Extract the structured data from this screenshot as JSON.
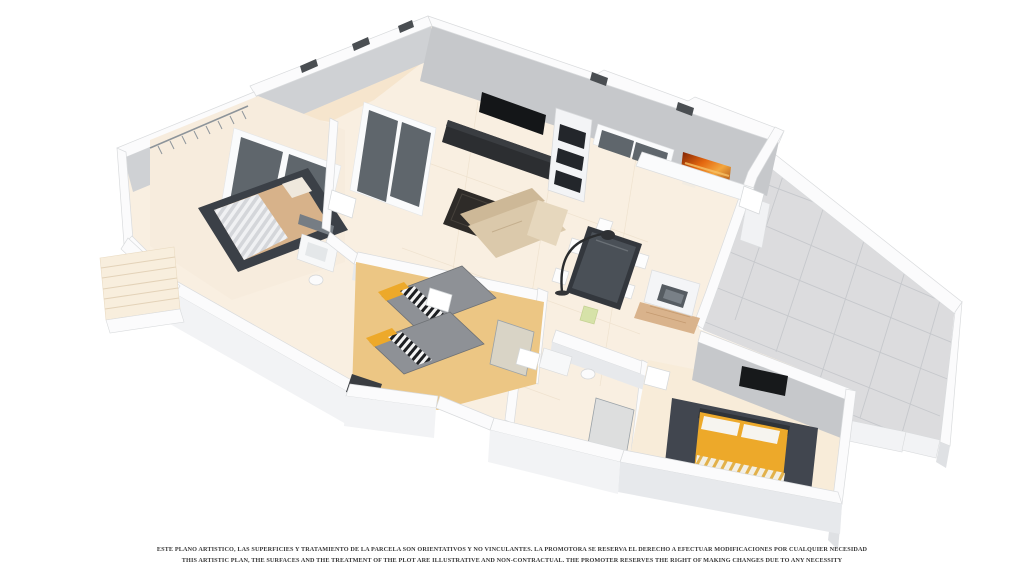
{
  "scene": {
    "type": "3d-floor-plan-render",
    "elements": [
      "patio",
      "bedroom-1",
      "closet",
      "bathroom-1",
      "staircase",
      "twin-bedroom",
      "hallway",
      "living-room",
      "tv-unit",
      "display-cabinet",
      "sofa",
      "coffee-table",
      "dining-table",
      "floor-lamp",
      "kitchen",
      "wall-art",
      "bathroom-2",
      "bathroom-3",
      "master-bedroom",
      "master-bed",
      "wall-tv",
      "terrace"
    ]
  },
  "disclaimer": {
    "line_es": "ESTE PLANO ARTISTICO, LAS SUPERFICIES Y TRATAMIENTO DE LA PARCELA SON ORIENTATIVOS Y NO VINCULANTES. LA PROMOTORA SE RESERVA EL DERECHO A EFECTUAR MODIFICACIONES POR CUALQUIER NECESIDAD",
    "line_en": "THIS ARTISTIC PLAN, THE SURFACES AND THE TREATMENT OF THE PLOT ARE ILLUSTRATIVE AND NON-CONTRACTUAL. THE PROMOTER RESERVES THE RIGHT OF MAKING CHANGES DUE TO ANY NECESSITY"
  },
  "colors": {
    "background": "#ffffff",
    "wall_top": "#fbfbfc",
    "wall_face_light": "#f2f3f5",
    "wall_face_dark": "#dfe1e4",
    "wall_inner": "#c6c8cb",
    "floor_cream": "#f9efe1",
    "floor_gold": "#ecc684",
    "floor_patio": "#f6e5cd",
    "floor_wood": "#d9b38c",
    "terrace_tile": "#dcdcde",
    "terrace_seam": "#c6c8cc",
    "furniture_dark": "#33373d",
    "sofa_beige": "#dbc9ab",
    "bed_tan": "#d7b28a",
    "accent_yellow": "#eda92a",
    "duvet_gray": "#8e9196",
    "art_orange": "#e06212",
    "glass_dark": "#5f666c",
    "text": "#383838"
  }
}
